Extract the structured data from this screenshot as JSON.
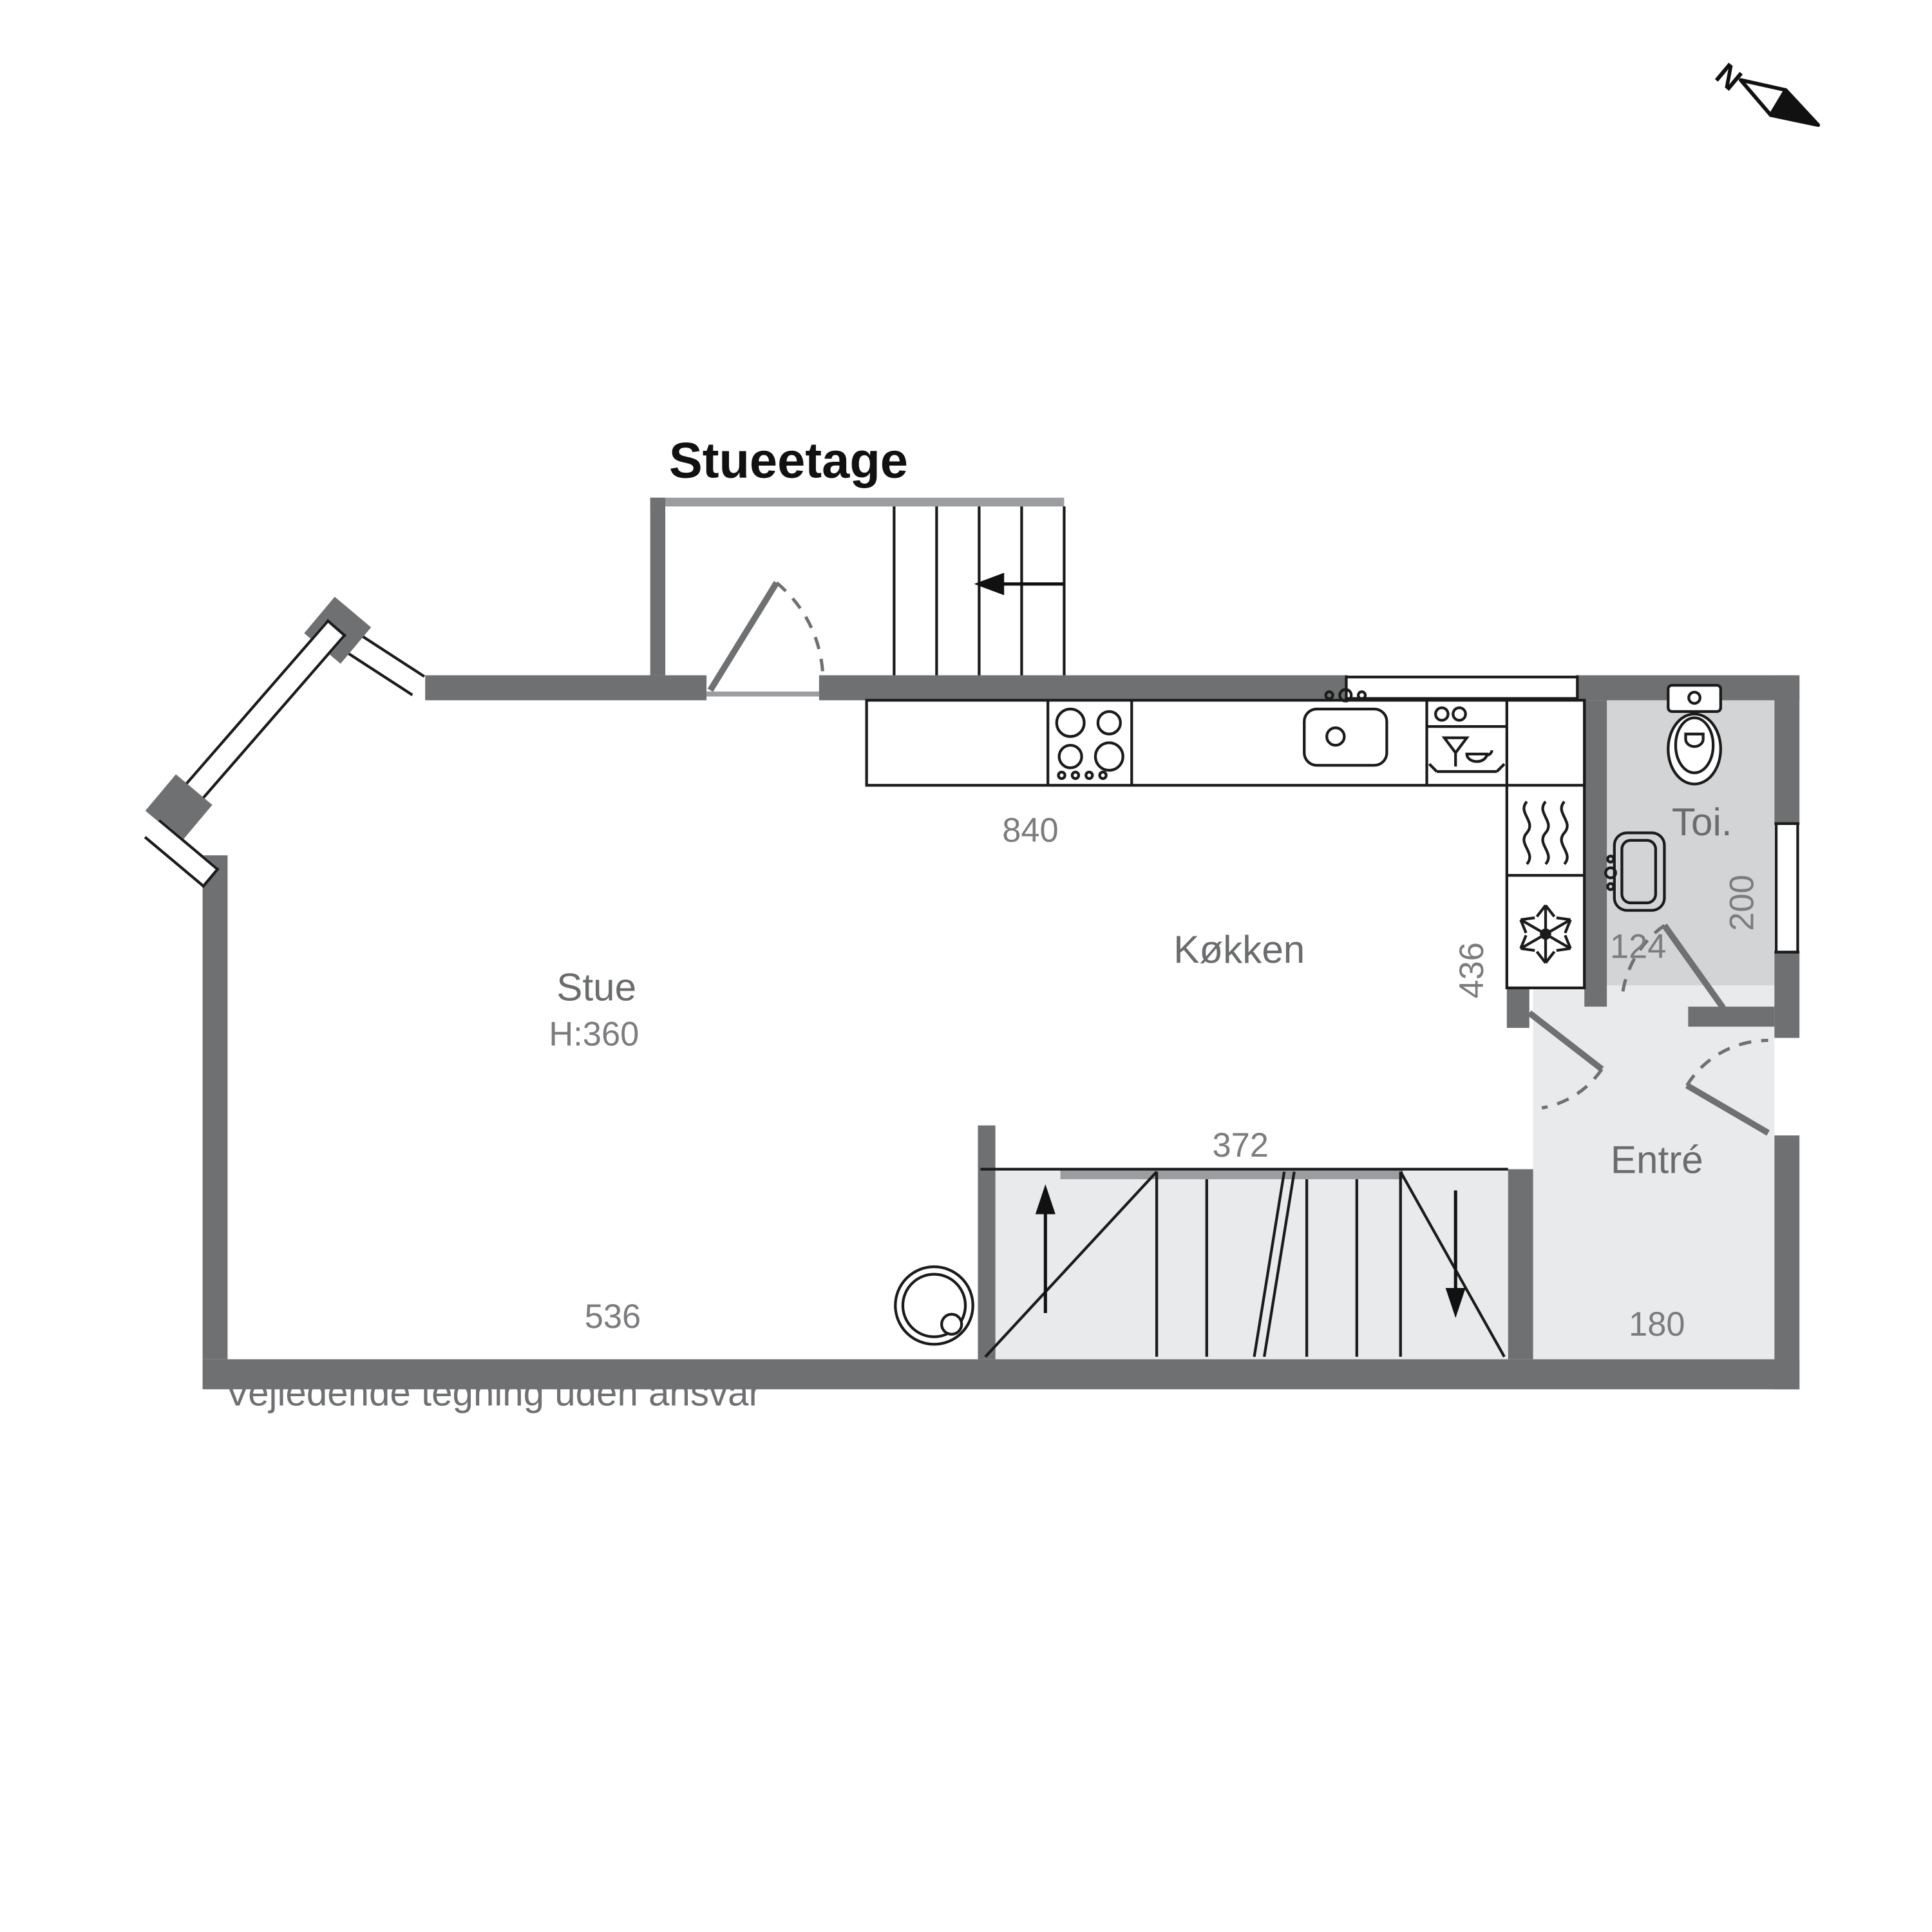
{
  "title": "Stueetage",
  "caption": "Vejledende tegning uden ansvar",
  "north_label": "N",
  "rooms": {
    "stue": {
      "name": "Stue",
      "ceiling_height": "H:360"
    },
    "kokken": {
      "name": "Køkken"
    },
    "toilet": {
      "name": "Toi."
    },
    "entre": {
      "name": "Entré"
    }
  },
  "dimensions": {
    "kokken_width": "840",
    "stue_width": "536",
    "stairs_width": "372",
    "kokken_depth": "436",
    "toilet_door_width": "124",
    "toilet_depth": "200",
    "entre_width": "180"
  },
  "colors": {
    "wall": "#6e7072",
    "room_light": "#e9eaeb",
    "room_toilet": "#d3d4d5",
    "outline": "#1b1b1b",
    "dimension_text": "#7b7c7e",
    "label_text": "#6b6c6e"
  }
}
